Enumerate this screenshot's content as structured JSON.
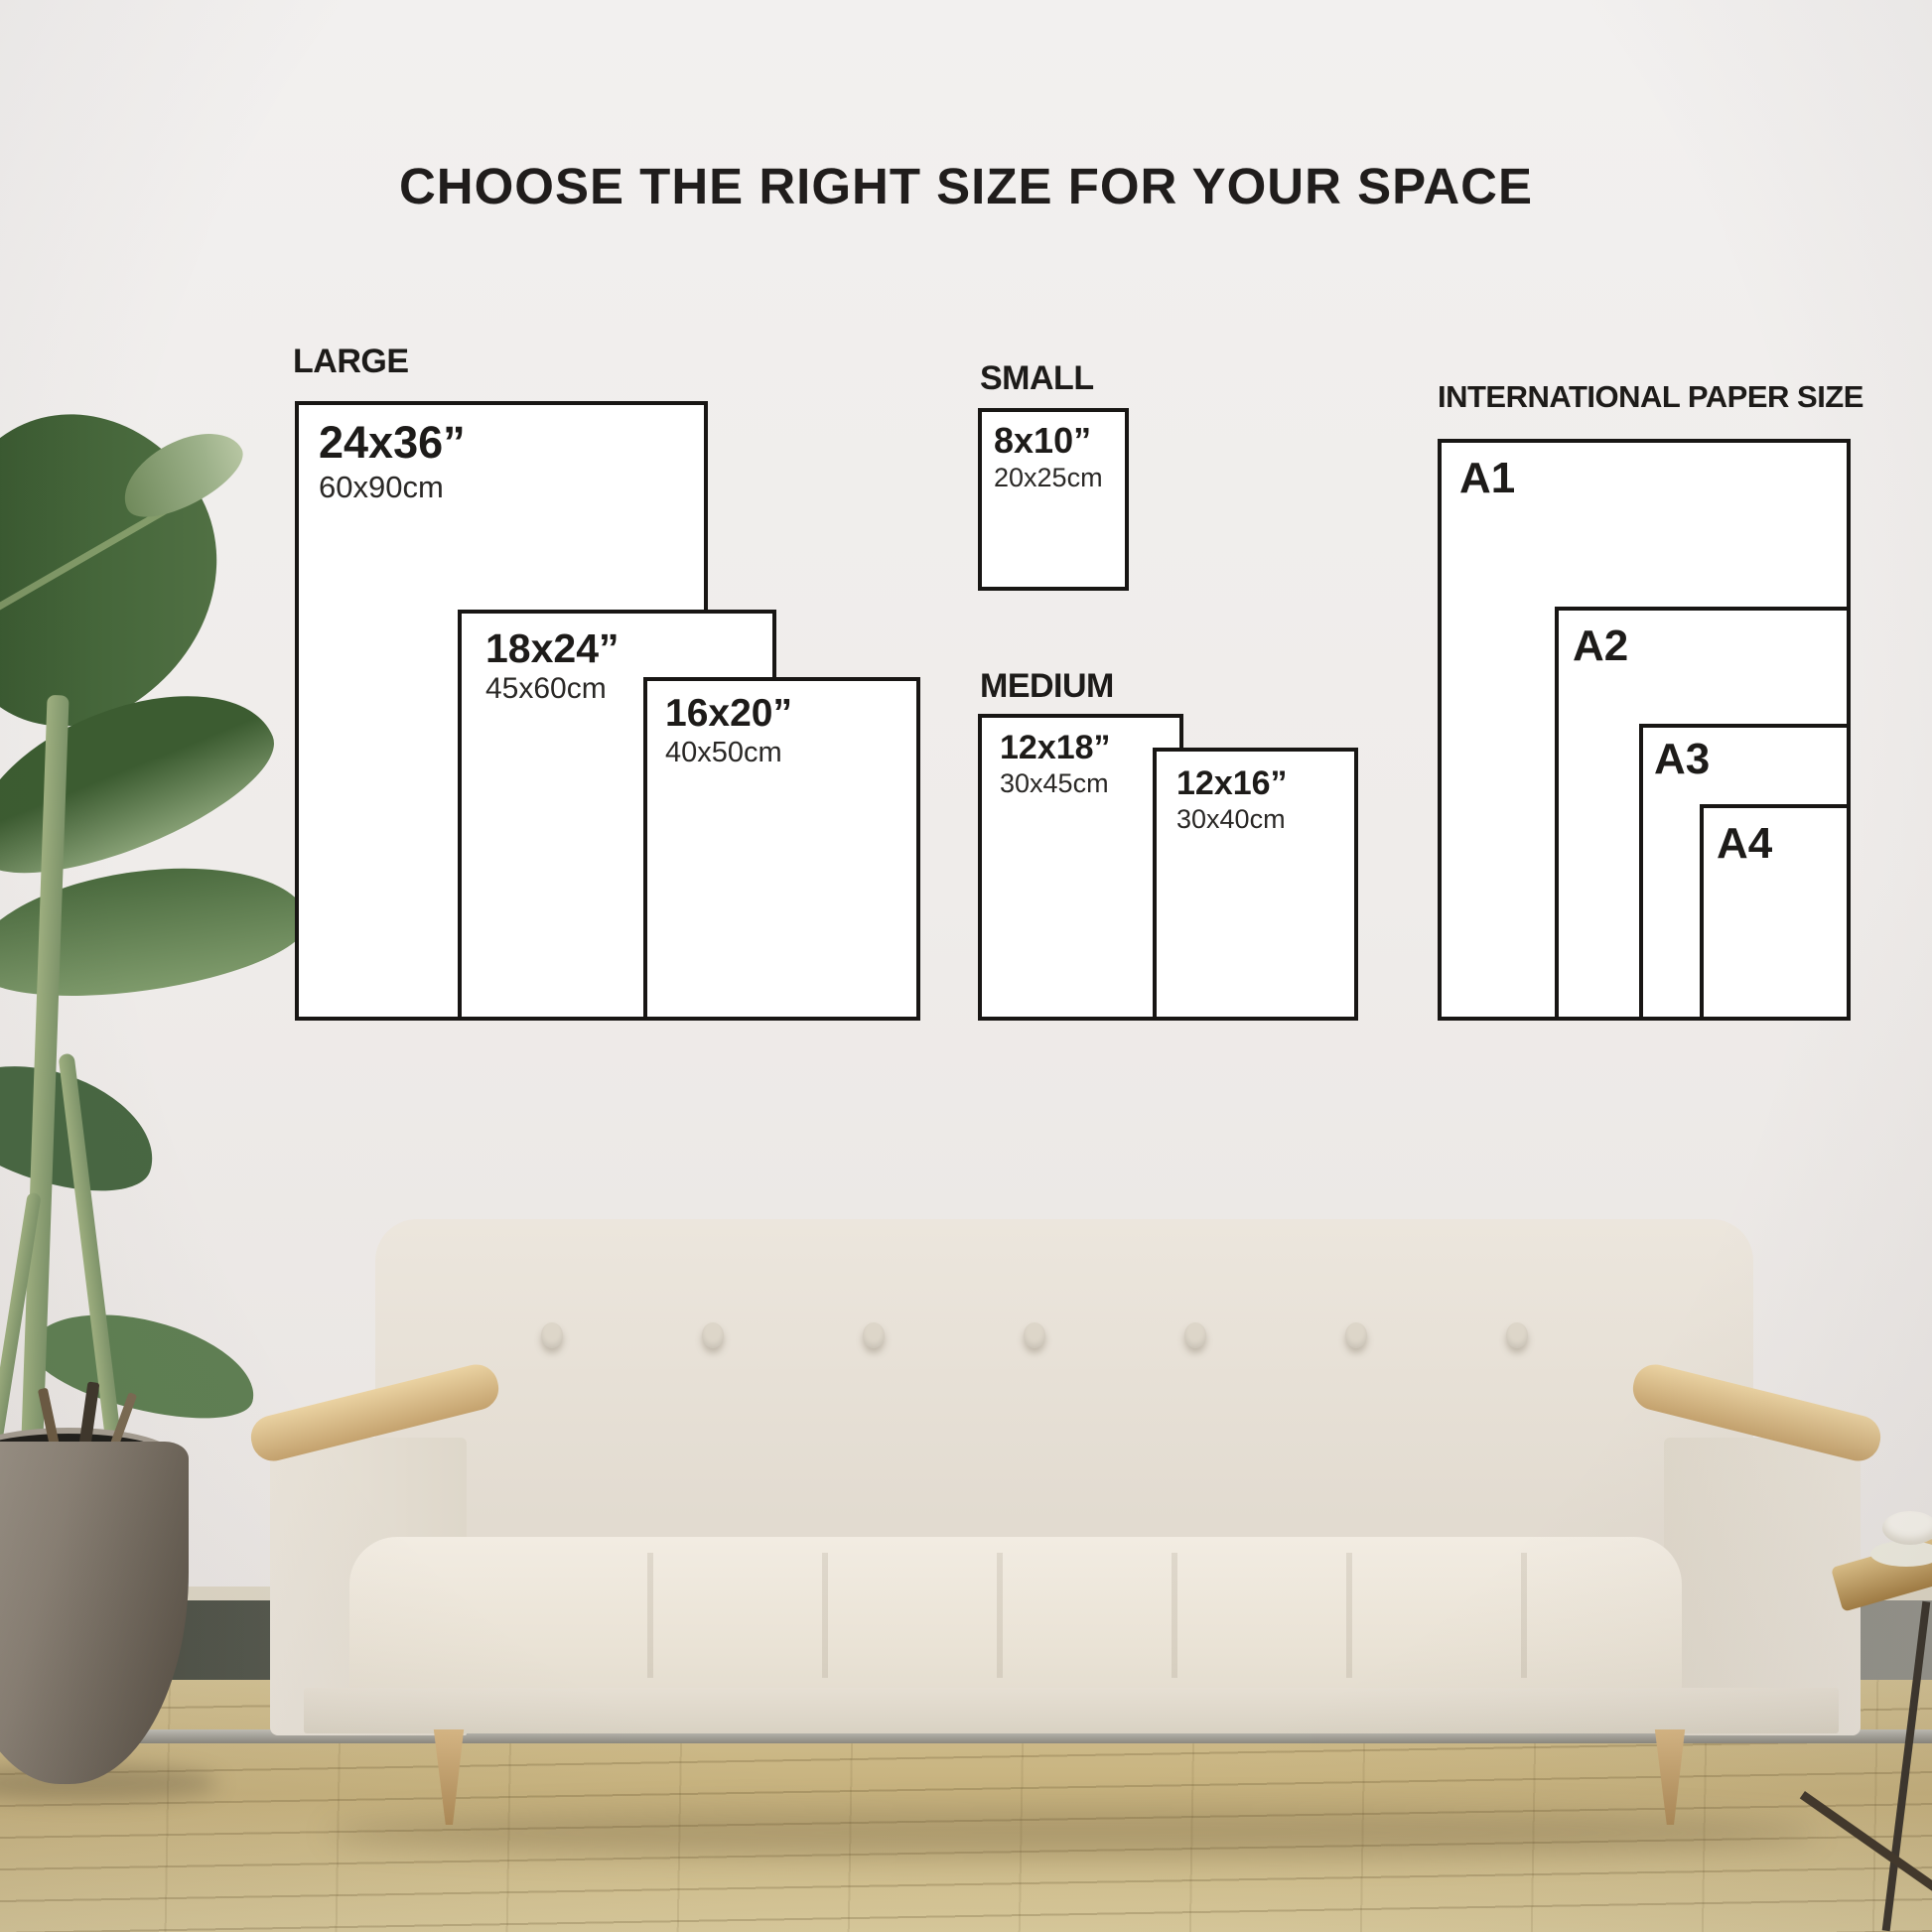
{
  "title": "CHOOSE THE RIGHT SIZE FOR YOUR SPACE",
  "groups": {
    "large": {
      "label": "LARGE",
      "sizes": [
        {
          "inches": "24x36”",
          "cm": "60x90cm"
        },
        {
          "inches": "18x24”",
          "cm": "45x60cm"
        },
        {
          "inches": "16x20”",
          "cm": "40x50cm"
        }
      ]
    },
    "small": {
      "label": "SMALL",
      "sizes": [
        {
          "inches": "8x10”",
          "cm": "20x25cm"
        }
      ]
    },
    "medium": {
      "label": "MEDIUM",
      "sizes": [
        {
          "inches": "12x18”",
          "cm": "30x45cm"
        },
        {
          "inches": "12x16”",
          "cm": "30x40cm"
        }
      ]
    },
    "international": {
      "label": "INTERNATIONAL PAPER SIZE",
      "sizes": [
        {
          "code": "A1"
        },
        {
          "code": "A2"
        },
        {
          "code": "A3"
        },
        {
          "code": "A4"
        }
      ]
    }
  },
  "colors": {
    "line": "#181614",
    "text": "#1d1b19",
    "wall": "#efecea",
    "floor": "#d8c99b",
    "paper": "#ffffff",
    "wood": "#ad8a57",
    "pot": "#8a8175",
    "leaf": "#45663a"
  }
}
